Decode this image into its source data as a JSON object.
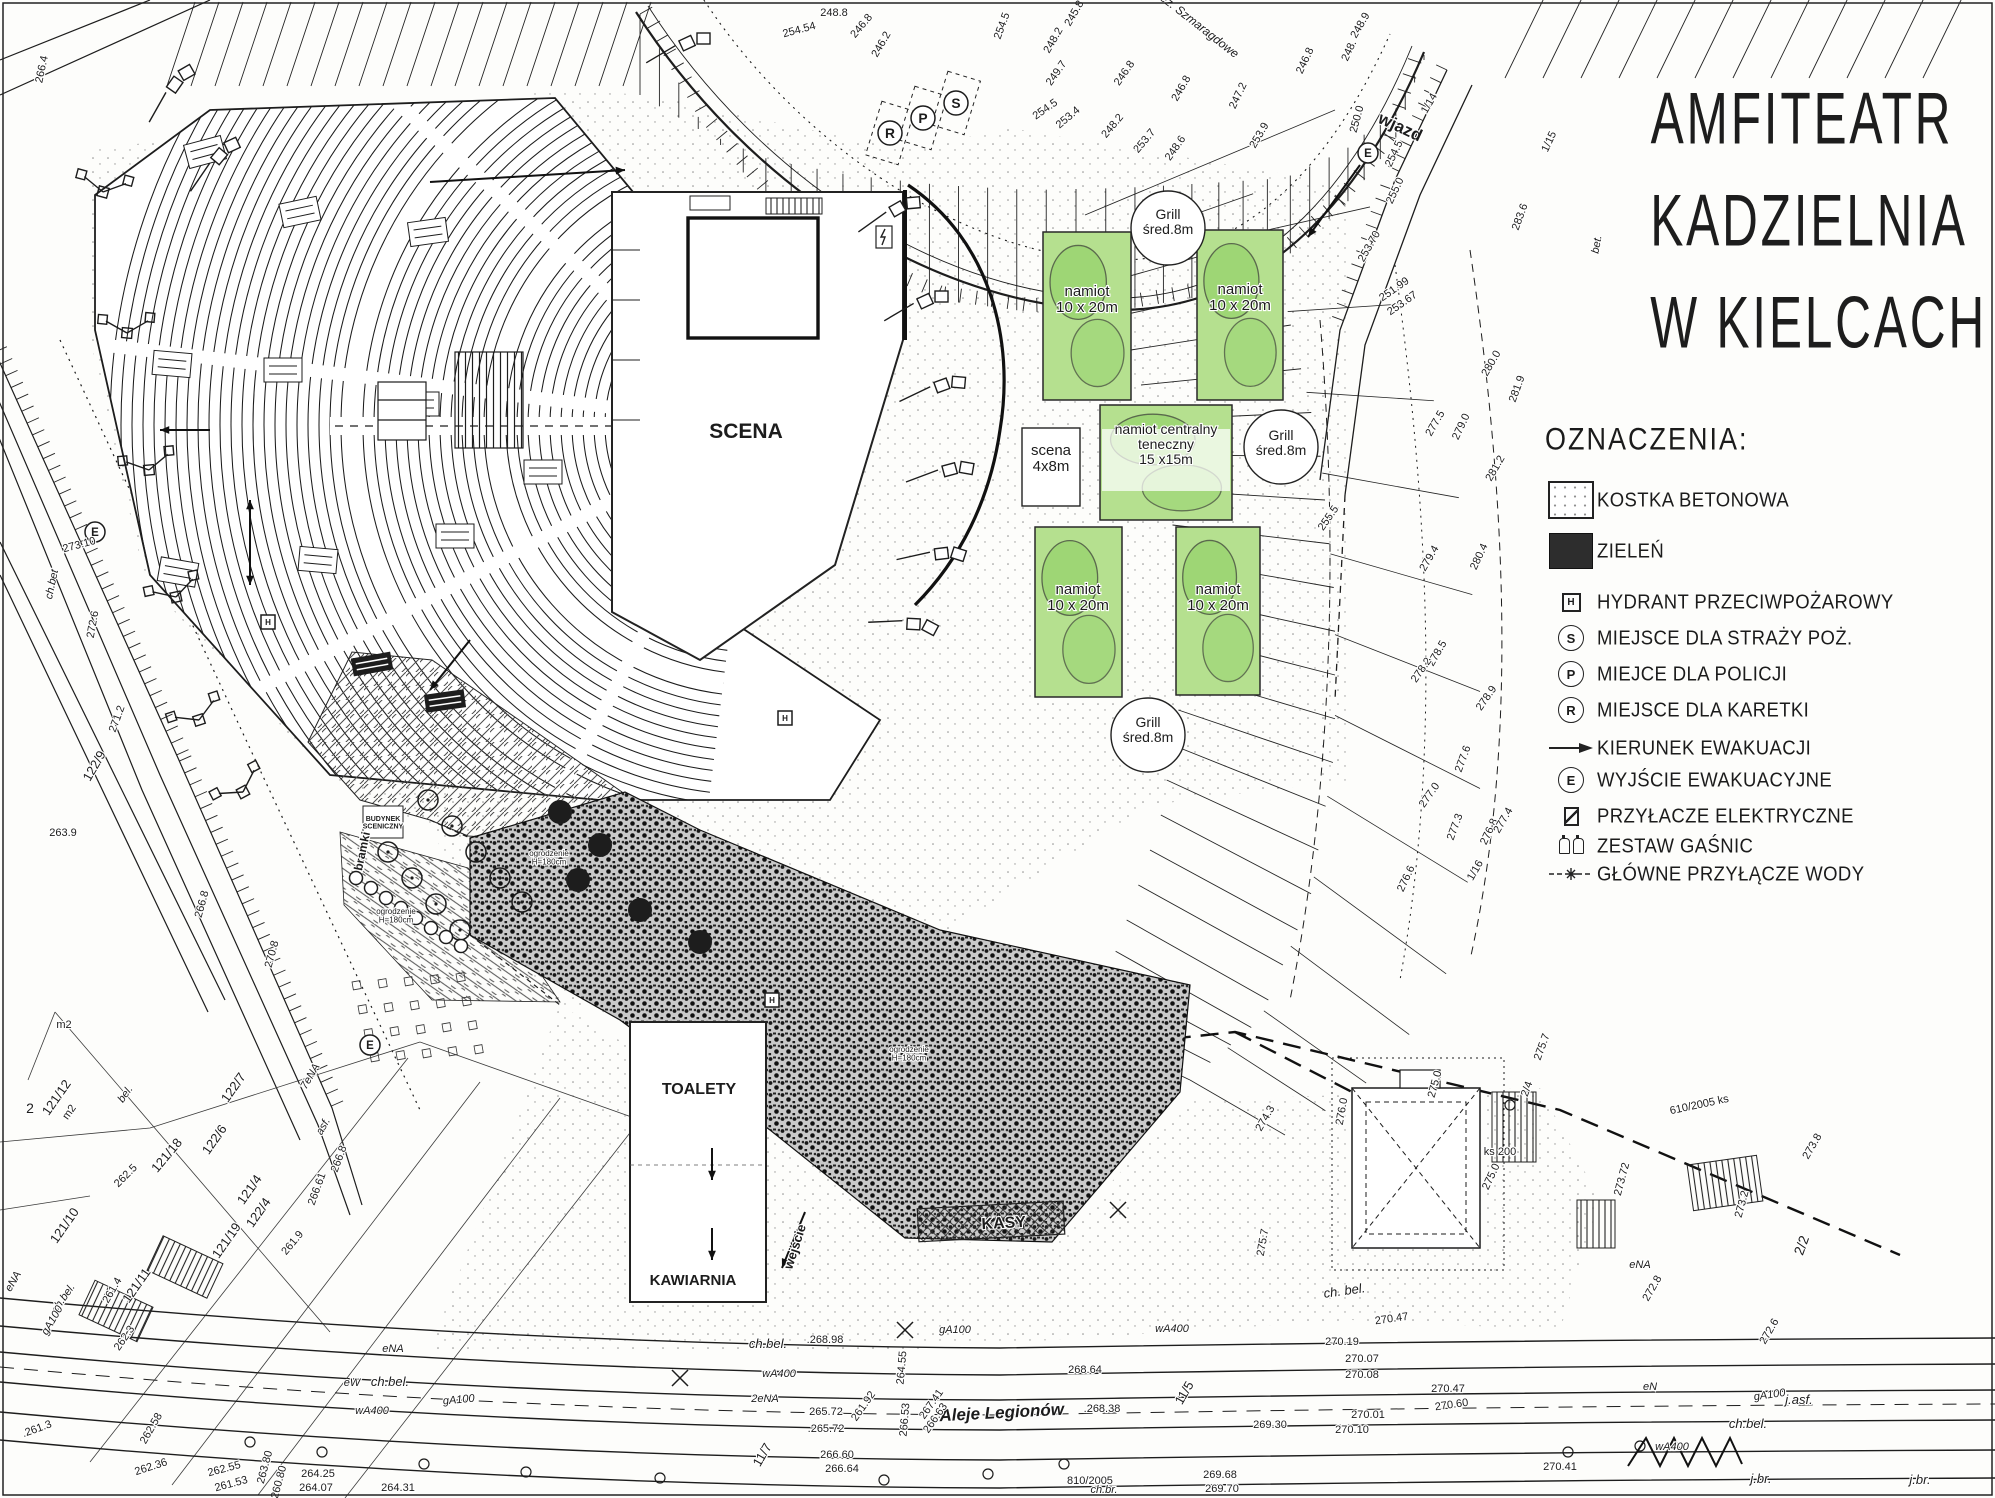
{
  "title": {
    "lines": [
      "AMFITEATR",
      "KADZIELNIA",
      "W KIELCACH"
    ]
  },
  "legend": {
    "heading": "OZNACZENIA:",
    "items": [
      {
        "key": "kostka",
        "label": "KOSTKA BETONOWA"
      },
      {
        "key": "zielen",
        "label": "ZIELEŃ"
      },
      {
        "key": "hydrant",
        "letter": "H",
        "label": "HYDRANT PRZECIWPOŻAROWY"
      },
      {
        "key": "straz",
        "letter": "S",
        "label": "MIEJSCE DLA STRAŻY POŻ."
      },
      {
        "key": "policja",
        "letter": "P",
        "label": "MIEJCE DLA POLICJI"
      },
      {
        "key": "karetka",
        "letter": "R",
        "label": "MIEJSCE DLA KARETKI"
      },
      {
        "key": "kierunek",
        "label": "KIERUNEK EWAKUACJI"
      },
      {
        "key": "wyjscie",
        "letter": "E",
        "label": "WYJŚCIE EWAKUACYJNE"
      },
      {
        "key": "elektryczne",
        "label": "PRZYŁACZE ELEKTRYCZNE"
      },
      {
        "key": "gasnice",
        "label": "ZESTAW GAŚNIC"
      },
      {
        "key": "woda",
        "label": "GŁÓWNE PRZYŁĄCZE WODY"
      }
    ]
  },
  "plan": {
    "markers": [
      {
        "t": "R",
        "x": 890,
        "y": 133,
        "shape": "circle",
        "rad": 12
      },
      {
        "t": "P",
        "x": 923,
        "y": 118,
        "shape": "circle",
        "rad": 12
      },
      {
        "t": "S",
        "x": 956,
        "y": 103,
        "shape": "circle",
        "rad": 12
      },
      {
        "t": "E",
        "x": 95,
        "y": 532,
        "shape": "circle",
        "rad": 10
      },
      {
        "t": "E",
        "x": 1368,
        "y": 153,
        "shape": "circle",
        "rad": 10
      },
      {
        "t": "E",
        "x": 370,
        "y": 1045,
        "shape": "circle",
        "rad": 10
      },
      {
        "t": "H",
        "x": 268,
        "y": 622,
        "shape": "square",
        "rad": 7
      },
      {
        "t": "H",
        "x": 785,
        "y": 718,
        "shape": "square",
        "rad": 7
      },
      {
        "t": "H",
        "x": 772,
        "y": 1000,
        "shape": "square",
        "rad": 7
      }
    ],
    "labels": [
      {
        "t": "SCENA",
        "x": 746,
        "y": 438,
        "s": 21,
        "c": "b"
      },
      {
        "t": "TOALETY",
        "x": 699,
        "y": 1094,
        "s": 16,
        "c": "b"
      },
      {
        "t": "KAWIARNIA",
        "x": 693,
        "y": 1285,
        "s": 15,
        "c": "b"
      },
      {
        "t": "KASY",
        "x": 1004,
        "y": 1228,
        "r": -3,
        "s": 16,
        "c": "b"
      },
      {
        "t": "wejście",
        "x": 799,
        "y": 1248,
        "r": -72,
        "s": 13,
        "c": "b"
      },
      {
        "t": "bramki",
        "x": 366,
        "y": 852,
        "r": -78,
        "s": 12,
        "c": "b"
      },
      {
        "t": "wjazd",
        "x": 1398,
        "y": 132,
        "r": 25,
        "s": 17,
        "c": "b"
      },
      {
        "t": "Aleje Legionów",
        "x": 1002,
        "y": 1418,
        "r": -3,
        "s": 17,
        "c": "bi"
      },
      {
        "t": "jez. Szmaragdowe",
        "x": 1196,
        "y": 28,
        "r": 38,
        "s": 12,
        "c": "i"
      },
      {
        "t": "Grill\nśred.8m",
        "x": 1168,
        "y": 219,
        "s": 14
      },
      {
        "t": "Grill\nśred.8m",
        "x": 1281,
        "y": 440,
        "s": 14
      },
      {
        "t": "Grill\nśred.8m",
        "x": 1148,
        "y": 727,
        "s": 14
      },
      {
        "t": "namiot\n10 x 20m",
        "x": 1087,
        "y": 296,
        "s": 15
      },
      {
        "t": "namiot\n10 x 20m",
        "x": 1240,
        "y": 294,
        "s": 15
      },
      {
        "t": "namiot centralny\nteneczny\n15 x15m",
        "x": 1166,
        "y": 434,
        "s": 14
      },
      {
        "t": "namiot\n10 x 20m",
        "x": 1078,
        "y": 594,
        "s": 15
      },
      {
        "t": "namiot\n10 x 20m",
        "x": 1218,
        "y": 594,
        "s": 15
      },
      {
        "t": "scena\n4x8m",
        "x": 1051,
        "y": 455,
        "s": 15
      },
      {
        "t": "BUDYNEK\nSCENICZNY",
        "x": 383,
        "y": 821,
        "s": 7,
        "c": "b"
      },
      {
        "t": "ogrodzenie\nH=180cm",
        "x": 549,
        "y": 856,
        "s": 8
      },
      {
        "t": "ogrodzenie\nH=180cm",
        "x": 396,
        "y": 914,
        "s": 8
      },
      {
        "t": "ogrodzenie\nH=180cm",
        "x": 909,
        "y": 1052,
        "s": 8
      },
      {
        "t": "248.8",
        "x": 834,
        "y": 16
      },
      {
        "t": "254.54",
        "x": 800,
        "y": 33,
        "r": -15
      },
      {
        "t": "246.8",
        "x": 864,
        "y": 28,
        "r": -50
      },
      {
        "t": "246.2",
        "x": 884,
        "y": 46,
        "r": -60
      },
      {
        "t": "254.5",
        "x": 1005,
        "y": 27,
        "r": -70
      },
      {
        "t": "245.8",
        "x": 1077,
        "y": 15,
        "r": -60
      },
      {
        "t": "248.2",
        "x": 1056,
        "y": 42,
        "r": -60
      },
      {
        "t": "249.7",
        "x": 1059,
        "y": 75,
        "r": -55
      },
      {
        "t": "246.8",
        "x": 1127,
        "y": 75,
        "r": -55
      },
      {
        "t": "246.8",
        "x": 1184,
        "y": 90,
        "r": -60
      },
      {
        "t": "247.2",
        "x": 1241,
        "y": 97,
        "r": -65
      },
      {
        "t": "253.4",
        "x": 1070,
        "y": 120,
        "r": -40
      },
      {
        "t": "254.5",
        "x": 1047,
        "y": 112,
        "r": -35
      },
      {
        "t": "248.2",
        "x": 1115,
        "y": 128,
        "r": -50
      },
      {
        "t": "253.7",
        "x": 1147,
        "y": 143,
        "r": -50
      },
      {
        "t": "248.6",
        "x": 1178,
        "y": 150,
        "r": -55
      },
      {
        "t": "253.9",
        "x": 1262,
        "y": 137,
        "r": -60
      },
      {
        "t": "246.8",
        "x": 1308,
        "y": 62,
        "r": -65
      },
      {
        "t": "248.9",
        "x": 1363,
        "y": 27,
        "r": -60
      },
      {
        "t": "248.",
        "x": 1352,
        "y": 52,
        "r": -65
      },
      {
        "t": "250.0",
        "x": 1360,
        "y": 120,
        "r": -75
      },
      {
        "t": "254.5",
        "x": 1397,
        "y": 155,
        "r": -65
      },
      {
        "t": "255.0",
        "x": 1398,
        "y": 192,
        "r": -65
      },
      {
        "t": "253.70",
        "x": 1372,
        "y": 248,
        "r": -60
      },
      {
        "t": "251.99",
        "x": 1396,
        "y": 292,
        "r": -35
      },
      {
        "t": "253.67",
        "x": 1404,
        "y": 306,
        "r": -35
      },
      {
        "t": "283.6",
        "x": 1523,
        "y": 218,
        "r": -70
      },
      {
        "t": "1/14",
        "x": 1432,
        "y": 105,
        "r": -60
      },
      {
        "t": "1/15",
        "x": 1552,
        "y": 143,
        "r": -65
      },
      {
        "t": "bet.",
        "x": 1600,
        "y": 245,
        "r": -80,
        "c": "i"
      },
      {
        "t": "280.0",
        "x": 1494,
        "y": 365,
        "r": -60
      },
      {
        "t": "281.9",
        "x": 1520,
        "y": 390,
        "r": -70
      },
      {
        "t": "277.5",
        "x": 1438,
        "y": 425,
        "r": -60
      },
      {
        "t": "279.0",
        "x": 1464,
        "y": 428,
        "r": -65
      },
      {
        "t": "281.2",
        "x": 1498,
        "y": 470,
        "r": -60
      },
      {
        "t": "255.5",
        "x": 1331,
        "y": 520,
        "r": -55
      },
      {
        "t": "279.4",
        "x": 1432,
        "y": 560,
        "r": -60
      },
      {
        "t": "280.4",
        "x": 1482,
        "y": 558,
        "r": -65
      },
      {
        "t": "278.5",
        "x": 1440,
        "y": 655,
        "r": -60
      },
      {
        "t": "278.2",
        "x": 1424,
        "y": 672,
        "r": -55
      },
      {
        "t": "278.9",
        "x": 1489,
        "y": 700,
        "r": -55
      },
      {
        "t": "277.6",
        "x": 1466,
        "y": 760,
        "r": -70
      },
      {
        "t": "277.0",
        "x": 1432,
        "y": 797,
        "r": -55
      },
      {
        "t": "277.3",
        "x": 1458,
        "y": 828,
        "r": -70
      },
      {
        "t": "276.8",
        "x": 1492,
        "y": 833,
        "r": -65
      },
      {
        "t": "277.4",
        "x": 1506,
        "y": 822,
        "r": -60
      },
      {
        "t": "1/16",
        "x": 1478,
        "y": 872,
        "r": -60
      },
      {
        "t": "276.6",
        "x": 1409,
        "y": 880,
        "r": -65
      },
      {
        "t": "275.7",
        "x": 1545,
        "y": 1048,
        "r": -70
      },
      {
        "t": "2/4",
        "x": 1530,
        "y": 1090,
        "r": -70
      },
      {
        "t": "275.0",
        "x": 1438,
        "y": 1085,
        "r": -75
      },
      {
        "t": "276.0",
        "x": 1345,
        "y": 1112,
        "r": -80
      },
      {
        "t": "275.0",
        "x": 1494,
        "y": 1178,
        "r": -65
      },
      {
        "t": "274.3",
        "x": 1268,
        "y": 1120,
        "r": -60
      },
      {
        "t": "273.8",
        "x": 1815,
        "y": 1148,
        "r": -60
      },
      {
        "t": "273.72",
        "x": 1625,
        "y": 1180,
        "r": -75
      },
      {
        "t": "610/2005 ks",
        "x": 1700,
        "y": 1108,
        "r": -12
      },
      {
        "t": "ks 200",
        "x": 1500,
        "y": 1155
      },
      {
        "t": "273.2",
        "x": 1745,
        "y": 1205,
        "r": -75
      },
      {
        "t": "2/2",
        "x": 1806,
        "y": 1247,
        "r": -70,
        "s": 14
      },
      {
        "t": "272.8",
        "x": 1655,
        "y": 1290,
        "r": -60
      },
      {
        "t": "272.6",
        "x": 1772,
        "y": 1333,
        "r": -60
      },
      {
        "t": "275.7",
        "x": 1266,
        "y": 1243,
        "r": -80
      },
      {
        "t": "ch. bel.",
        "x": 1345,
        "y": 1295,
        "r": -8,
        "s": 13,
        "c": "i"
      },
      {
        "t": "eNA",
        "x": 1640,
        "y": 1268,
        "c": "i"
      },
      {
        "t": "gA100",
        "x": 1770,
        "y": 1398,
        "r": -8,
        "c": "i"
      },
      {
        "t": "ch.bel.",
        "x": 1748,
        "y": 1428,
        "s": 13,
        "c": "i"
      },
      {
        "t": "wA400",
        "x": 1672,
        "y": 1450,
        "c": "i"
      },
      {
        "t": "j.br.",
        "x": 1761,
        "y": 1483,
        "s": 13,
        "c": "i"
      },
      {
        "t": "j.br.",
        "x": 1920,
        "y": 1484,
        "s": 13,
        "c": "i"
      },
      {
        "t": "j.asf.",
        "x": 1799,
        "y": 1404,
        "s": 13,
        "c": "i"
      },
      {
        "t": "eN",
        "x": 1650,
        "y": 1390,
        "c": "i"
      },
      {
        "t": "270.47",
        "x": 1392,
        "y": 1322,
        "r": -8
      },
      {
        "t": "270.19",
        "x": 1342,
        "y": 1345
      },
      {
        "t": "270.07",
        "x": 1362,
        "y": 1362
      },
      {
        "t": "270.08",
        "x": 1362,
        "y": 1378
      },
      {
        "t": "270.01",
        "x": 1368,
        "y": 1418
      },
      {
        "t": "270.10",
        "x": 1352,
        "y": 1433
      },
      {
        "t": "270.47",
        "x": 1448,
        "y": 1392
      },
      {
        "t": "270.60",
        "x": 1452,
        "y": 1408,
        "r": -8
      },
      {
        "t": "270.41",
        "x": 1560,
        "y": 1470
      },
      {
        "t": "269.30",
        "x": 1270,
        "y": 1428
      },
      {
        "t": "269.68",
        "x": 1220,
        "y": 1478
      },
      {
        "t": "269.70",
        "x": 1222,
        "y": 1492
      },
      {
        "t": "11/5",
        "x": 1188,
        "y": 1395,
        "r": -60,
        "s": 13
      },
      {
        "t": "ch.bel.",
        "x": 768,
        "y": 1348,
        "s": 13,
        "c": "i"
      },
      {
        "t": ".268.98",
        "x": 825,
        "y": 1343
      },
      {
        "t": "wA400",
        "x": 779,
        "y": 1377,
        "c": "i"
      },
      {
        "t": "2eNA",
        "x": 765,
        "y": 1402,
        "c": "i"
      },
      {
        "t": "265.72",
        "x": 826,
        "y": 1415
      },
      {
        "t": ".265.72",
        "x": 826,
        "y": 1432
      },
      {
        "t": "266.60",
        "x": 837,
        "y": 1458
      },
      {
        "t": "266.64",
        "x": 842,
        "y": 1472
      },
      {
        "t": "268.64",
        "x": 1085,
        "y": 1373
      },
      {
        "t": ".268.38",
        "x": 1102,
        "y": 1412
      },
      {
        "t": "264.55",
        "x": 905,
        "y": 1368,
        "r": -85
      },
      {
        "t": "266.53",
        "x": 908,
        "y": 1420,
        "r": -85
      },
      {
        "t": "267.41",
        "x": 934,
        "y": 1406,
        "r": -55
      },
      {
        "t": "266.63",
        "x": 938,
        "y": 1420,
        "r": -55
      },
      {
        "t": "261.92",
        "x": 866,
        "y": 1408,
        "r": -55
      },
      {
        "t": "gA100",
        "x": 955,
        "y": 1333,
        "c": "i"
      },
      {
        "t": "wA400",
        "x": 1172,
        "y": 1332,
        "c": "i"
      },
      {
        "t": "810/2005",
        "x": 1090,
        "y": 1484
      },
      {
        "t": "ch.br.",
        "x": 1104,
        "y": 1493,
        "c": "i"
      },
      {
        "t": "eNA",
        "x": 393,
        "y": 1352,
        "c": "i"
      },
      {
        "t": "eW",
        "x": 352,
        "y": 1386,
        "c": "i"
      },
      {
        "t": "ch.bel.",
        "x": 390,
        "y": 1386,
        "s": 13,
        "c": "i"
      },
      {
        "t": "wA400",
        "x": 372,
        "y": 1414,
        "c": "i"
      },
      {
        "t": "gA100",
        "x": 459,
        "y": 1403,
        "r": -5,
        "c": "i"
      },
      {
        "t": "11/7",
        "x": 766,
        "y": 1457,
        "r": -60,
        "s": 13
      },
      {
        "t": "264.25",
        "x": 318,
        "y": 1477
      },
      {
        "t": "264.07",
        "x": 316,
        "y": 1491
      },
      {
        "t": "264.31",
        "x": 398,
        "y": 1491
      },
      {
        "t": "262.55",
        "x": 225,
        "y": 1472,
        "r": -15
      },
      {
        "t": "261.53",
        "x": 232,
        "y": 1487,
        "r": -15
      },
      {
        "t": "263.80",
        "x": 268,
        "y": 1468,
        "r": -75
      },
      {
        "t": "260.80",
        "x": 282,
        "y": 1483,
        "r": -75
      },
      {
        "t": "262.36",
        "x": 152,
        "y": 1470,
        "r": -18
      },
      {
        "t": "121/12",
        "x": 60,
        "y": 1100,
        "r": -55,
        "s": 13
      },
      {
        "t": "m2",
        "x": 72,
        "y": 1114,
        "r": -55
      },
      {
        "t": "2",
        "x": 30,
        "y": 1113,
        "s": 14
      },
      {
        "t": "m2",
        "x": 64,
        "y": 1028
      },
      {
        "t": "bel.",
        "x": 128,
        "y": 1096,
        "r": -55,
        "c": "i"
      },
      {
        "t": "121/18",
        "x": 170,
        "y": 1158,
        "r": -50,
        "s": 13
      },
      {
        "t": "122/7",
        "x": 237,
        "y": 1090,
        "r": -55,
        "s": 13
      },
      {
        "t": "122/6",
        "x": 218,
        "y": 1142,
        "r": -55,
        "s": 13
      },
      {
        "t": "asf.",
        "x": 326,
        "y": 1128,
        "r": -60,
        "c": "i"
      },
      {
        "t": "7eNA",
        "x": 313,
        "y": 1078,
        "r": -60,
        "c": "i"
      },
      {
        "t": "266.8",
        "x": 342,
        "y": 1160,
        "r": -70
      },
      {
        "t": "266.61",
        "x": 320,
        "y": 1190,
        "r": -70
      },
      {
        "t": "121/10",
        "x": 68,
        "y": 1228,
        "r": -55,
        "s": 13
      },
      {
        "t": "122/4",
        "x": 262,
        "y": 1215,
        "r": -55,
        "s": 13
      },
      {
        "t": "261.9",
        "x": 295,
        "y": 1245,
        "r": -50
      },
      {
        "t": "121/11",
        "x": 140,
        "y": 1288,
        "r": -55,
        "s": 13
      },
      {
        "t": "261.4",
        "x": 115,
        "y": 1292,
        "r": -60
      },
      {
        "t": "121/19",
        "x": 230,
        "y": 1243,
        "r": -55,
        "s": 13
      },
      {
        "t": "262.5",
        "x": 128,
        "y": 1178,
        "r": -45
      },
      {
        "t": "121/4",
        "x": 253,
        "y": 1192,
        "r": -55,
        "s": 13
      },
      {
        "t": "ch.bel.",
        "x": 66,
        "y": 1300,
        "r": -55,
        "c": "i"
      },
      {
        "t": "gA100",
        "x": 55,
        "y": 1322,
        "r": -60,
        "c": "i"
      },
      {
        "t": "eNA",
        "x": 16,
        "y": 1283,
        "r": -60,
        "c": "i"
      },
      {
        "t": "262.3",
        "x": 127,
        "y": 1340,
        "r": -55
      },
      {
        "t": ".261.3",
        "x": 38,
        "y": 1432,
        "r": -20
      },
      {
        "t": "262.58",
        "x": 154,
        "y": 1430,
        "r": -60
      },
      {
        "t": "ch.bet",
        "x": 55,
        "y": 585,
        "r": -78,
        "c": "i"
      },
      {
        "t": "273.10",
        "x": 80,
        "y": 548,
        "r": -15
      },
      {
        "t": "272.6",
        "x": 96,
        "y": 625,
        "r": -80
      },
      {
        "t": "271.2",
        "x": 120,
        "y": 720,
        "r": -70
      },
      {
        "t": "122/9",
        "x": 98,
        "y": 768,
        "r": -60,
        "s": 13
      },
      {
        "t": "263.9",
        "x": 63,
        "y": 836
      },
      {
        "t": "266.8",
        "x": 205,
        "y": 905,
        "r": -75
      },
      {
        "t": "270.8",
        "x": 275,
        "y": 955,
        "r": -75
      },
      {
        "t": "266.4",
        "x": 45,
        "y": 70,
        "r": -78
      }
    ]
  }
}
